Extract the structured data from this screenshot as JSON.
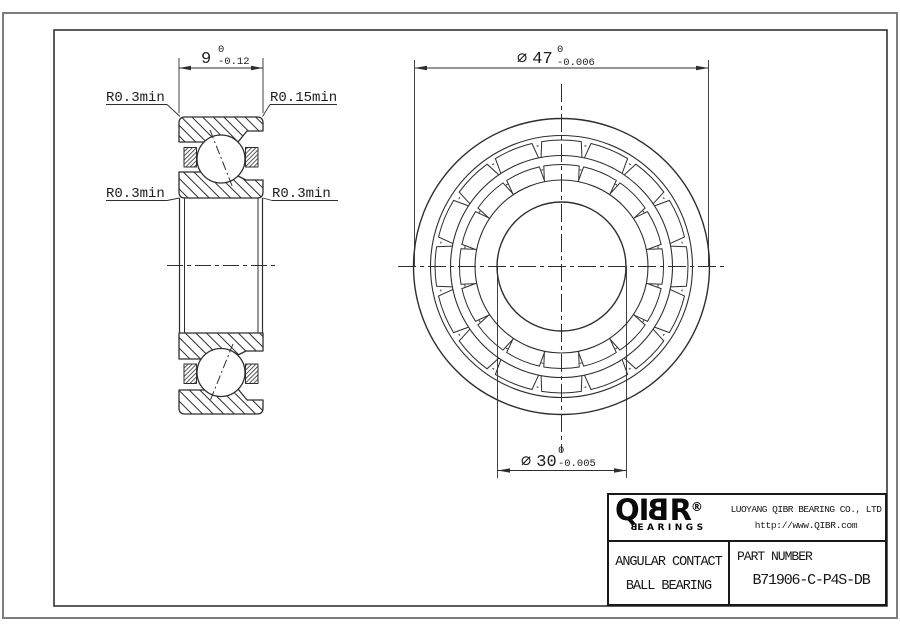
{
  "drawing": {
    "side_view": {
      "width_dim": {
        "value": "9",
        "tol_upper": "0",
        "tol_lower": "-0.12"
      },
      "radius_labels": {
        "top_left": "R0.3min",
        "top_right": "R0.15min",
        "bottom_left": "R0.3min",
        "bottom_right": "R0.3min"
      }
    },
    "front_view": {
      "od_dim": {
        "symbol": "⌀",
        "value": "47",
        "tol_upper": "0",
        "tol_lower": "-0.006"
      },
      "bore_dim": {
        "symbol": "⌀",
        "value": "30",
        "tol_upper": "0",
        "tol_lower": "-0.005"
      }
    }
  },
  "title_block": {
    "logo": {
      "part1": "QI",
      "part2": "B",
      "part3": "R",
      "registered": "®",
      "tagline_first": "B",
      "tagline_rest": "EARINGS"
    },
    "company": "LUOYANG QIBR BEARING CO., LTD",
    "website": "http://www.QIBR.com",
    "product": {
      "line1": "ANGULAR CONTACT",
      "line2": "BALL BEARING"
    },
    "part_number_label": "PART NUMBER",
    "part_number": "B71906-C-P4S-DB"
  },
  "colors": {
    "background": "#ffffff",
    "line": "#2e2e2e",
    "outer_border": "#7d7d7d",
    "frame": "#333333",
    "text": "#1d1d1d"
  }
}
